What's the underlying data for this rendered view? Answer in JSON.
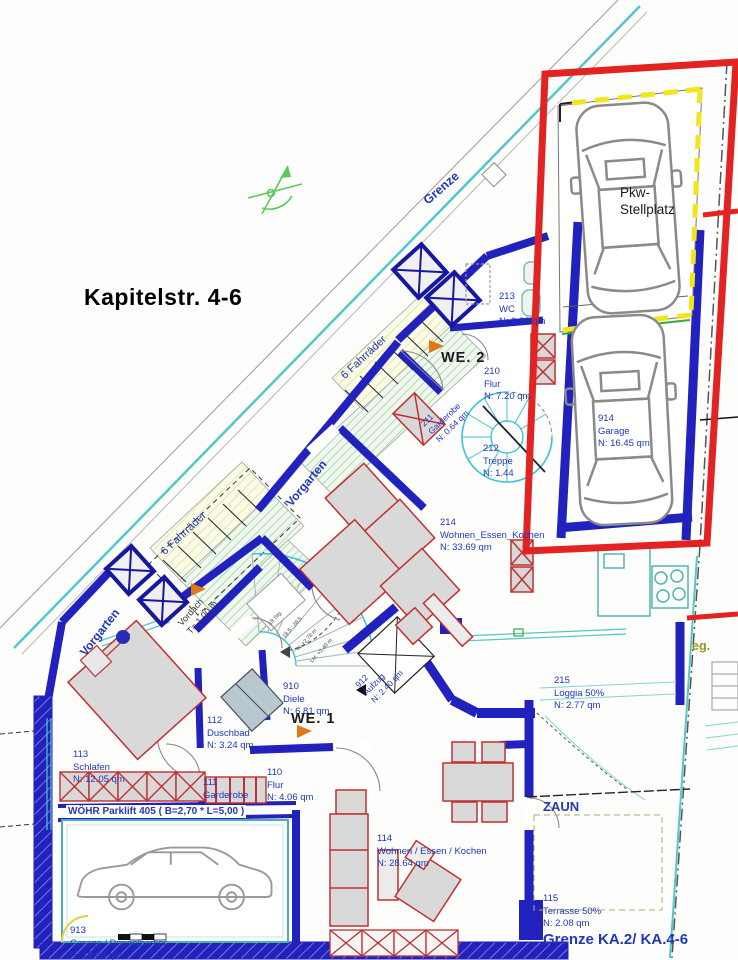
{
  "title": "Kapitelstr. 4-6",
  "site": {
    "grenze": "Grenze",
    "grenze_ka": "Grenze KA.2/ KA.4-6",
    "zaun": "ZAUN",
    "weg": "eg.",
    "vorgarten": "Vorgarten",
    "fahrraeder": "6 Fahrräder",
    "vordach_line1": "Vordach",
    "vordach_line2": "T= 1.00 m"
  },
  "units": {
    "we1": "WE. 1",
    "we2": "WE. 2"
  },
  "highlight": {
    "line1": "Pkw-",
    "line2": "Stellplatz",
    "color": "#e32222"
  },
  "annotations": {
    "parklift": "WÖHR Parklift 405 ( B=2,70 * L=5,00 )",
    "stairs_line1": "18 Stg.",
    "stairs_line2": "18,5 : 26,5",
    "stairs_line3": "H: +2,78 m",
    "stairs_line4": "LH: +2,40 m"
  },
  "rooms": [
    {
      "number": "213",
      "name": "WC",
      "area": "N: 2.88 qm"
    },
    {
      "number": "210",
      "name": "Flur",
      "area": "N: 7.20 qm"
    },
    {
      "number": "211",
      "name": "Garderobe",
      "area": "N: 0.64 qm"
    },
    {
      "number": "212",
      "name": "Treppe",
      "area": "N: 1.44"
    },
    {
      "number": "914",
      "name": "Garage",
      "area": "N: 16.45 qm"
    },
    {
      "number": "214",
      "name": "Wohnen_Essen_Kochen",
      "area": "N: 33.69 qm"
    },
    {
      "number": "215",
      "name": "Loggia 50%",
      "area": "N: 2.77 qm"
    },
    {
      "number": "910",
      "name": "Diele",
      "area": "N: 6.81 qm"
    },
    {
      "number": "912",
      "name": "Aufzug",
      "area": "N: 2.40 qm"
    },
    {
      "number": "110",
      "name": "Flur",
      "area": "N: 4.06 qm"
    },
    {
      "number": "111",
      "name": "Garderobe",
      "area": ""
    },
    {
      "number": "112",
      "name": "Duschbad",
      "area": "N: 3.24 qm"
    },
    {
      "number": "113",
      "name": "Schlafen",
      "area": "N: 12.05 qm"
    },
    {
      "number": "114",
      "name": "Wohnen / Essen / Kochen",
      "area": "N: 28.64 qm"
    },
    {
      "number": "115",
      "name": "Terrasse 50%",
      "area": "N: 2.08 qm"
    },
    {
      "number": "913",
      "name": "Garage / Doppelparker",
      "area": "N: 18.69 qm"
    }
  ]
}
